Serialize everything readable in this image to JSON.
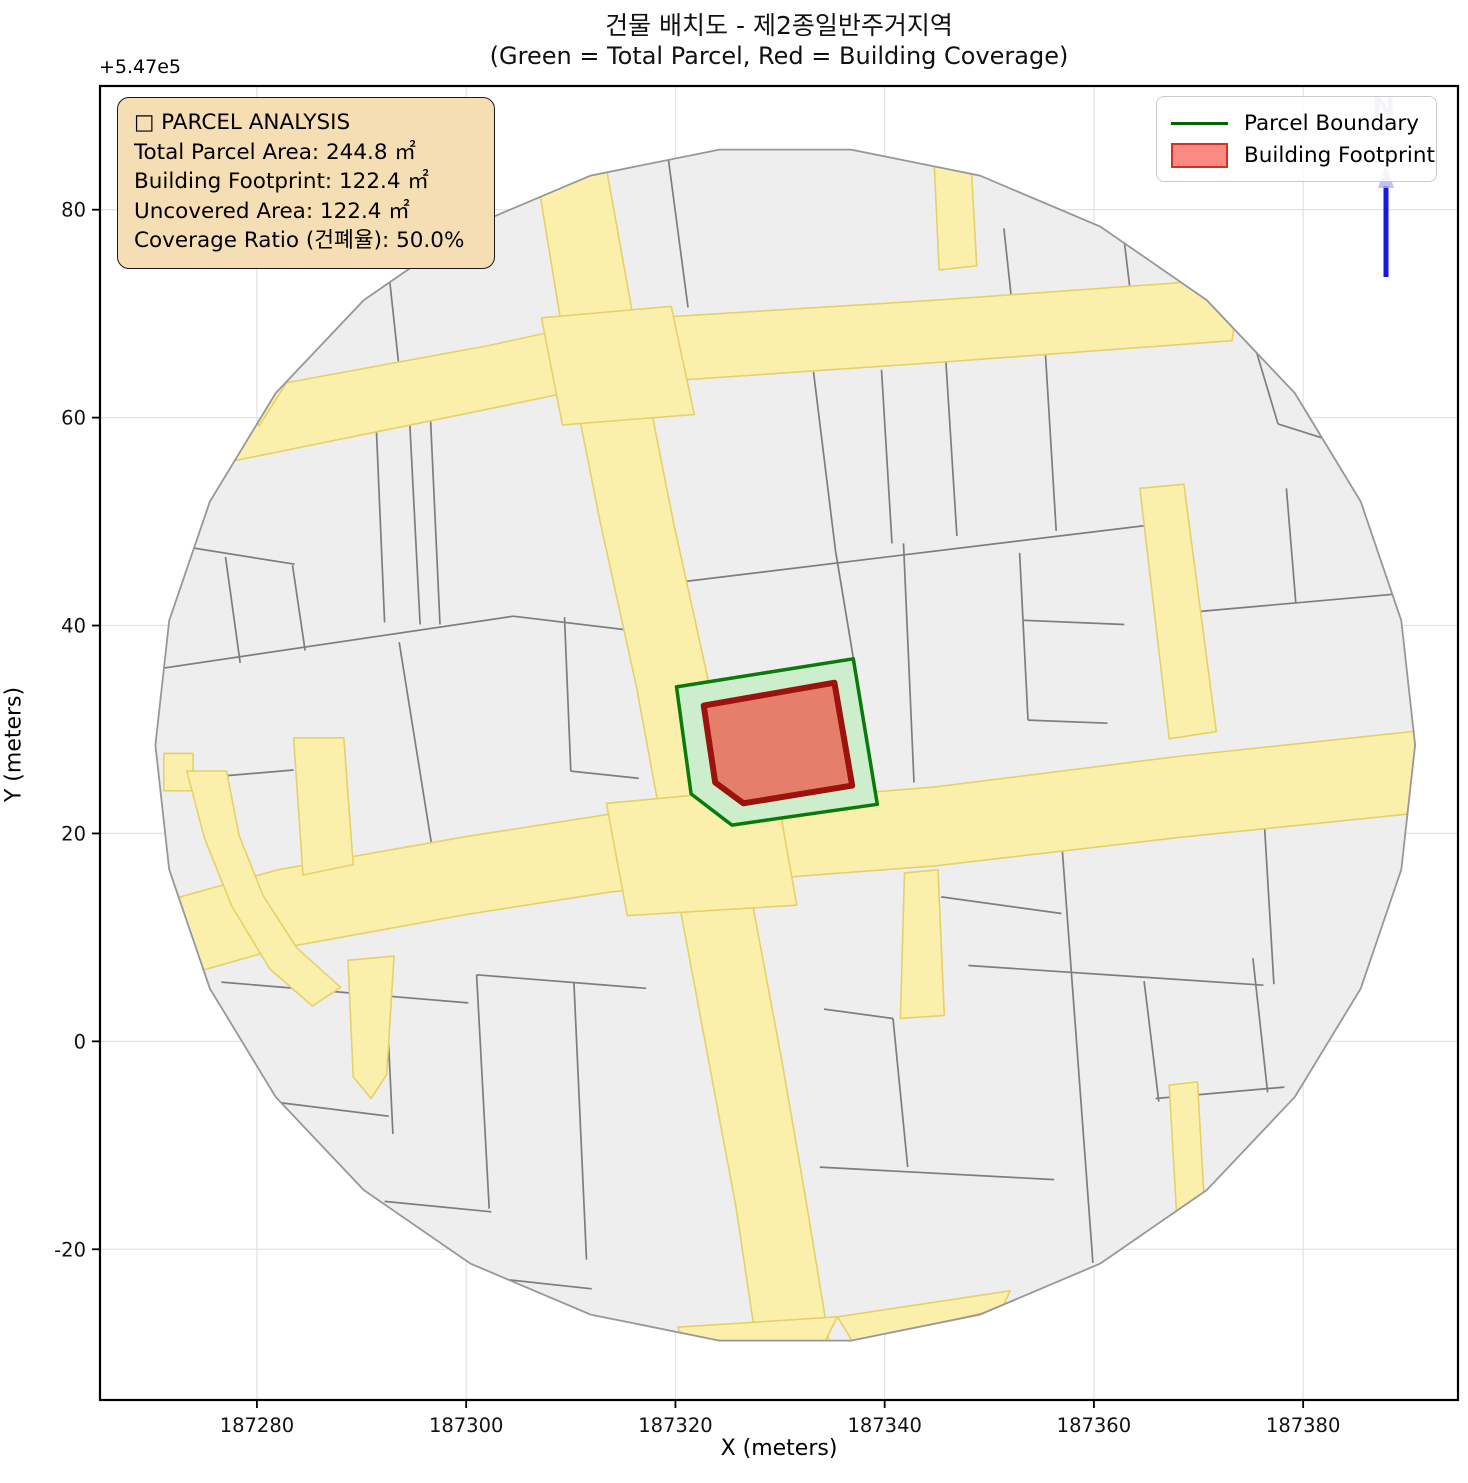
{
  "title": {
    "line1": "건물 배치도 - 제2종일반주거지역",
    "line2": "(Green = Total Parcel, Red = Building Coverage)"
  },
  "axes": {
    "xlabel": "X (meters)",
    "ylabel": "Y (meters)",
    "offset_text": "+5.47e5",
    "x_ticks": [
      187280,
      187300,
      187320,
      187340,
      187360,
      187380
    ],
    "y_ticks": [
      80,
      60,
      40,
      20,
      0,
      -20
    ],
    "x_range": [
      187265.0,
      187394.8
    ],
    "y_range": [
      -34.5,
      91.9
    ],
    "grid": true
  },
  "legend": {
    "items": [
      {
        "label": "Parcel Boundary",
        "type": "line",
        "color": "#006400"
      },
      {
        "label": "Building Footprint",
        "type": "patch",
        "fill": "#fb8a84",
        "stroke": "#d93025"
      }
    ]
  },
  "info_box": {
    "title": "□ PARCEL ANALYSIS",
    "lines": [
      "Total Parcel Area:  244.8 ㎡",
      "Building Footprint:  122.4 ㎡",
      "Uncovered Area:  122.4 ㎡",
      "Coverage Ratio (건폐율):  50.0%"
    ]
  },
  "north_arrow": {
    "label": "N",
    "line_color": "#1717e6",
    "head_color": "#aab4ea"
  },
  "chart_data": {
    "type": "map",
    "title": "건물 배치도 - 제2종일반주거지역 (Green = Total Parcel, Red = Building Coverage)",
    "xlabel": "X (meters)",
    "ylabel": "Y (meters)",
    "y_offset": 547000,
    "xlim": [
      187265.0,
      187394.8
    ],
    "ylim": [
      -34.5,
      91.9
    ],
    "stats": {
      "total_parcel_area_m2": 244.8,
      "building_footprint_m2": 122.4,
      "uncovered_area_m2": 122.4,
      "coverage_ratio_pct": 50.0
    },
    "colors": {
      "parcel_base": "#eeeeee",
      "parcel_edge": "#7d7d7d",
      "boundary_edge": "#979797",
      "road_fill": "#fbf0ab",
      "road_edge": "#e6d068",
      "parcel_fill": "#cdeecd",
      "parcel_stroke": "#0a7a0a",
      "building_fill": "#e57f6b",
      "building_stroke": "#9c130e",
      "grid": "#e4e4e4"
    },
    "boundary": {
      "cx": 187330.5,
      "cy": 28.5,
      "rx": 60.2,
      "ry": 57.6,
      "segments": 30
    },
    "parcel_polygon": [
      [
        187320.1,
        34.1
      ],
      [
        187337.0,
        36.8
      ],
      [
        187339.3,
        22.8
      ],
      [
        187325.4,
        20.8
      ],
      [
        187321.5,
        23.8
      ]
    ],
    "building_polygon": [
      [
        187322.7,
        32.3
      ],
      [
        187335.2,
        34.5
      ],
      [
        187336.9,
        24.6
      ],
      [
        187326.5,
        22.9
      ],
      [
        187323.8,
        24.9
      ]
    ],
    "roads": [
      {
        "name": "main-vertical-road",
        "pts": [
          [
            187306.2,
            86.8
          ],
          [
            187312.9,
            86.8
          ],
          [
            187316.2,
            68.3
          ],
          [
            187319.8,
            50
          ],
          [
            187323.3,
            34
          ],
          [
            187325.4,
            22.5
          ],
          [
            187327.6,
            12
          ],
          [
            187330.2,
            -2
          ],
          [
            187332.6,
            -16
          ],
          [
            187334.8,
            -29.6
          ],
          [
            187327.9,
            -30.2
          ],
          [
            187325.8,
            -16
          ],
          [
            187323.2,
            -2
          ],
          [
            187320.6,
            12
          ],
          [
            187318.4,
            22.5
          ],
          [
            187316.3,
            34
          ],
          [
            187312.8,
            50
          ],
          [
            187309.2,
            68.3
          ]
        ]
      },
      {
        "name": "upper-horizontal-road",
        "pts": [
          [
            187276.6,
            55.6
          ],
          [
            187302,
            60.8
          ],
          [
            187313,
            63.1
          ],
          [
            187345,
            65.3
          ],
          [
            187373.2,
            67.4
          ],
          [
            187374,
            73.4
          ],
          [
            187345,
            71.3
          ],
          [
            187313,
            69.3
          ],
          [
            187302,
            66.9
          ],
          [
            187276,
            62.1
          ]
        ]
      },
      {
        "name": "main-horizontal-road",
        "pts": [
          [
            187269.8,
            5.4
          ],
          [
            187282,
            8.9
          ],
          [
            187300,
            12.2
          ],
          [
            187314,
            14.4
          ],
          [
            187332,
            15.9
          ],
          [
            187345,
            16.9
          ],
          [
            187368,
            19.6
          ],
          [
            187392.3,
            22.1
          ],
          [
            187392.3,
            30
          ],
          [
            187368,
            27.4
          ],
          [
            187345,
            24.5
          ],
          [
            187332,
            23.4
          ],
          [
            187314,
            21.9
          ],
          [
            187300,
            19.7
          ],
          [
            187282,
            16.5
          ],
          [
            187269.8,
            13.1
          ]
        ]
      },
      {
        "name": "junction-flare-upper",
        "pts": [
          [
            187307.2,
            69.6
          ],
          [
            187319.6,
            70.7
          ],
          [
            187321.8,
            60.3
          ],
          [
            187309.2,
            59.3
          ]
        ]
      },
      {
        "name": "junction-flare-main",
        "pts": [
          [
            187313.4,
            22.9
          ],
          [
            187329.6,
            24.4
          ],
          [
            187331.6,
            13.1
          ],
          [
            187315.4,
            12.1
          ]
        ]
      },
      {
        "name": "north-stub-road",
        "pts": [
          [
            187344.6,
            87.4
          ],
          [
            187348.1,
            87.4
          ],
          [
            187348.8,
            74.6
          ],
          [
            187345.2,
            74.2
          ]
        ]
      },
      {
        "name": "east-narrow-road",
        "pts": [
          [
            187364.4,
            53.2
          ],
          [
            187368.6,
            53.6
          ],
          [
            187371.7,
            29.8
          ],
          [
            187367.2,
            29.1
          ]
        ]
      },
      {
        "name": "south-stub-road",
        "pts": [
          [
            187341.9,
            16.2
          ],
          [
            187345.1,
            16.5
          ],
          [
            187345.7,
            2.5
          ],
          [
            187341.5,
            2.2
          ]
        ]
      },
      {
        "name": "west-narrow-upper",
        "pts": [
          [
            187283.5,
            29.2
          ],
          [
            187288.3,
            29.2
          ],
          [
            187289.2,
            17
          ],
          [
            187284.4,
            16
          ]
        ]
      },
      {
        "name": "west-narrow-lower",
        "pts": [
          [
            187288.7,
            7.8
          ],
          [
            187293.1,
            8.2
          ],
          [
            187292.4,
            -3.2
          ],
          [
            187290.9,
            -5.5
          ],
          [
            187289.2,
            -3.4
          ]
        ]
      },
      {
        "name": "left-edge-stub",
        "pts": [
          [
            187271.1,
            27.7
          ],
          [
            187273.9,
            27.7
          ],
          [
            187273.9,
            24.1
          ],
          [
            187271.1,
            24.1
          ]
        ]
      },
      {
        "name": "left-edge-arc-road",
        "pts": [
          [
            187273.3,
            26
          ],
          [
            187275,
            19.5
          ],
          [
            187277.6,
            13
          ],
          [
            187281.2,
            7
          ],
          [
            187285.3,
            3.4
          ],
          [
            187288,
            5.2
          ],
          [
            187283.8,
            9
          ],
          [
            187280.6,
            14
          ],
          [
            187278.3,
            19.8
          ],
          [
            187277.1,
            26
          ]
        ]
      },
      {
        "name": "bottom-fan",
        "pts": [
          [
            187320.2,
            -27.5
          ],
          [
            187335.5,
            -26.5
          ],
          [
            187333.8,
            -29.8
          ],
          [
            187327,
            -31
          ],
          [
            187321.5,
            -29.8
          ]
        ]
      },
      {
        "name": "bottom-edge-strip",
        "pts": [
          [
            187335.5,
            -26.5
          ],
          [
            187352,
            -24
          ],
          [
            187351.2,
            -25.7
          ],
          [
            187337,
            -29
          ]
        ]
      },
      {
        "name": "topleft-triangle",
        "pts": [
          [
            187278.6,
            62.6
          ],
          [
            187283.8,
            64.9
          ],
          [
            187280.2,
            59.2
          ]
        ]
      },
      {
        "name": "southeast-narrow",
        "pts": [
          [
            187367.2,
            -4.2
          ],
          [
            187369.9,
            -3.9
          ],
          [
            187370.6,
            -16.3
          ],
          [
            187367.9,
            -16.6
          ]
        ]
      }
    ],
    "parcel_lines": [
      [
        [
          187292,
          79.6
        ],
        [
          187293.6,
          64.7
        ]
      ],
      [
        [
          187319.2,
          85.8
        ],
        [
          187321.2,
          70.6
        ]
      ],
      [
        [
          187351.4,
          78.2
        ],
        [
          187352.4,
          68.8
        ]
      ],
      [
        [
          187362.7,
          78.6
        ],
        [
          187363.8,
          69.4
        ]
      ],
      [
        [
          187374.2,
          70.8
        ],
        [
          187377.6,
          59.4
        ]
      ],
      [
        [
          187377.6,
          59.4
        ],
        [
          187383.5,
          57.5
        ]
      ],
      [
        [
          187319,
          44
        ],
        [
          187364.8,
          49.6
        ]
      ],
      [
        [
          187333.2,
          64.4
        ],
        [
          187335.3,
          47.2
        ]
      ],
      [
        [
          187339.7,
          64.6
        ],
        [
          187340.7,
          47.9
        ]
      ],
      [
        [
          187345.8,
          66.3
        ],
        [
          187346.9,
          48.6
        ]
      ],
      [
        [
          187355.3,
          67.3
        ],
        [
          187356.4,
          49.1
        ]
      ],
      [
        [
          187335.3,
          47.2
        ],
        [
          187337,
          36.9
        ]
      ],
      [
        [
          187341.8,
          47.9
        ],
        [
          187342.8,
          24.9
        ]
      ],
      [
        [
          187352.9,
          47
        ],
        [
          187353.7,
          30.9
        ]
      ],
      [
        [
          187353.3,
          40.5
        ],
        [
          187362.9,
          40.1
        ]
      ],
      [
        [
          187353.7,
          30.9
        ],
        [
          187361.3,
          30.6
        ]
      ],
      [
        [
          187369.5,
          41.3
        ],
        [
          187388.6,
          43
        ]
      ],
      [
        [
          187378.4,
          53.2
        ],
        [
          187379.3,
          42.2
        ]
      ],
      [
        [
          187356.6,
          23.6
        ],
        [
          187359.9,
          -21.3
        ]
      ],
      [
        [
          187348,
          7.3
        ],
        [
          187376.2,
          5.4
        ]
      ],
      [
        [
          187364.8,
          5.8
        ],
        [
          187366.2,
          -5.8
        ]
      ],
      [
        [
          187365.9,
          -5.5
        ],
        [
          187378.2,
          -4.4
        ]
      ],
      [
        [
          187375.2,
          8
        ],
        [
          187376.6,
          -4.9
        ]
      ],
      [
        [
          187345.4,
          13.9
        ],
        [
          187356.9,
          12.3
        ]
      ],
      [
        [
          187376.3,
          20.9
        ],
        [
          187377.2,
          5.5
        ]
      ],
      [
        [
          187334.2,
          3.1
        ],
        [
          187340.8,
          2.2
        ]
      ],
      [
        [
          187340.8,
          2.2
        ],
        [
          187342.2,
          -12.1
        ]
      ],
      [
        [
          187333.8,
          -12.1
        ],
        [
          187356.2,
          -13.3
        ]
      ],
      [
        [
          187276.6,
          5.7
        ],
        [
          187300.2,
          3.7
        ]
      ],
      [
        [
          187292.4,
          3.6
        ],
        [
          187293,
          -8.9
        ]
      ],
      [
        [
          187281.4,
          -5.8
        ],
        [
          187292.6,
          -7.2
        ]
      ],
      [
        [
          187301,
          6.4
        ],
        [
          187302.2,
          -16.1
        ]
      ],
      [
        [
          187292.2,
          -15.4
        ],
        [
          187302.4,
          -16.4
        ]
      ],
      [
        [
          187301,
          6.4
        ],
        [
          187317.2,
          5.1
        ]
      ],
      [
        [
          187310.3,
          5.7
        ],
        [
          187311.5,
          -21
        ]
      ],
      [
        [
          187302.8,
          -22.8
        ],
        [
          187312,
          -23.8
        ]
      ],
      [
        [
          187271,
          35.9
        ],
        [
          187304.5,
          40.9
        ]
      ],
      [
        [
          187304.5,
          40.9
        ],
        [
          187316.9,
          39.4
        ]
      ],
      [
        [
          187269.3,
          48.2
        ],
        [
          187283.6,
          45.9
        ]
      ],
      [
        [
          187277,
          46.6
        ],
        [
          187278.4,
          36.4
        ]
      ],
      [
        [
          187283.4,
          45.8
        ],
        [
          187284.6,
          37.6
        ]
      ],
      [
        [
          187291.4,
          59.3
        ],
        [
          187292.2,
          40.3
        ]
      ],
      [
        [
          187294.6,
          59.6
        ],
        [
          187295.6,
          40.1
        ]
      ],
      [
        [
          187296.6,
          59.7
        ],
        [
          187297.5,
          40.1
        ]
      ],
      [
        [
          187293.6,
          38.4
        ],
        [
          187297,
          17
        ]
      ],
      [
        [
          187309.4,
          40.8
        ],
        [
          187310,
          26
        ]
      ],
      [
        [
          187310,
          26
        ],
        [
          187316.5,
          25.3
        ]
      ],
      [
        [
          187271.8,
          25.1
        ],
        [
          187283.5,
          26.1
        ]
      ]
    ]
  },
  "plot": {
    "left": 100,
    "top": 86,
    "right": 1458,
    "bottom": 1400,
    "width": 1468,
    "height": 1483
  }
}
